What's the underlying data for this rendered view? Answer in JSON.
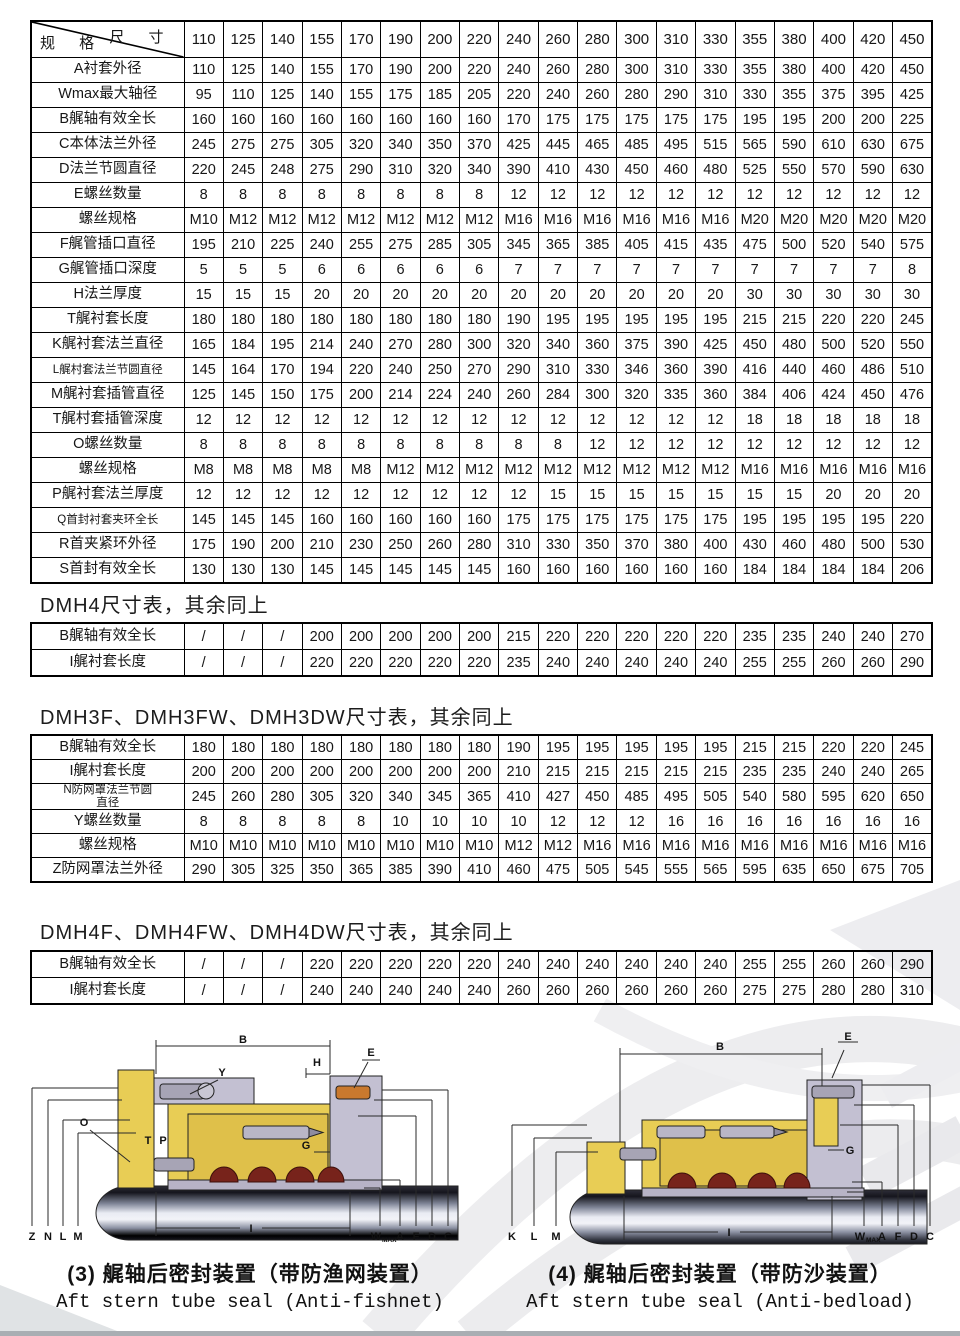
{
  "sizes_header": {
    "corner_top": "尺 寸",
    "corner_bottom": "规 格"
  },
  "tables": {
    "main": {
      "header": true,
      "columns": [
        "110",
        "125",
        "140",
        "155",
        "170",
        "190",
        "200",
        "220",
        "240",
        "260",
        "280",
        "300",
        "310",
        "330",
        "355",
        "380",
        "400",
        "420",
        "450"
      ],
      "rows": [
        {
          "label": "A衬套外径",
          "values": [
            110,
            125,
            140,
            155,
            170,
            190,
            200,
            220,
            240,
            260,
            280,
            300,
            310,
            330,
            355,
            380,
            400,
            420,
            450
          ]
        },
        {
          "label": "Wmax最大轴径",
          "values": [
            95,
            110,
            125,
            140,
            155,
            175,
            185,
            205,
            220,
            240,
            260,
            280,
            290,
            310,
            330,
            355,
            375,
            395,
            425
          ]
        },
        {
          "label": "B艉轴有效全长",
          "values": [
            160,
            160,
            160,
            160,
            160,
            160,
            160,
            160,
            170,
            175,
            175,
            175,
            175,
            175,
            195,
            195,
            200,
            200,
            225
          ]
        },
        {
          "label": "C本体法兰外径",
          "values": [
            245,
            275,
            275,
            305,
            320,
            340,
            350,
            370,
            425,
            445,
            465,
            485,
            495,
            515,
            565,
            590,
            610,
            630,
            675
          ]
        },
        {
          "label": "D法兰节圆直径",
          "values": [
            220,
            245,
            248,
            275,
            290,
            310,
            320,
            340,
            390,
            410,
            430,
            450,
            460,
            480,
            525,
            550,
            570,
            590,
            630
          ]
        },
        {
          "label": "E螺丝数量",
          "values": [
            8,
            8,
            8,
            8,
            8,
            8,
            8,
            8,
            12,
            12,
            12,
            12,
            12,
            12,
            12,
            12,
            12,
            12,
            12
          ]
        },
        {
          "label": "螺丝规格",
          "values": [
            "M10",
            "M12",
            "M12",
            "M12",
            "M12",
            "M12",
            "M12",
            "M12",
            "M16",
            "M16",
            "M16",
            "M16",
            "M16",
            "M16",
            "M20",
            "M20",
            "M20",
            "M20",
            "M20"
          ]
        },
        {
          "label": "F艉管插口直径",
          "values": [
            195,
            210,
            225,
            240,
            255,
            275,
            285,
            305,
            345,
            365,
            385,
            405,
            415,
            435,
            475,
            500,
            520,
            540,
            575
          ]
        },
        {
          "label": "G艉管插口深度",
          "values": [
            5,
            5,
            5,
            6,
            6,
            6,
            6,
            6,
            7,
            7,
            7,
            7,
            7,
            7,
            7,
            7,
            7,
            7,
            8
          ]
        },
        {
          "label": "H法兰厚度",
          "values": [
            15,
            15,
            15,
            20,
            20,
            20,
            20,
            20,
            20,
            20,
            20,
            20,
            20,
            20,
            30,
            30,
            30,
            30,
            30
          ]
        },
        {
          "label": "T艉衬套长度",
          "values": [
            180,
            180,
            180,
            180,
            180,
            180,
            180,
            180,
            190,
            195,
            195,
            195,
            195,
            195,
            215,
            215,
            220,
            220,
            245
          ]
        },
        {
          "label": "K艉衬套法兰直径",
          "values": [
            165,
            184,
            195,
            214,
            240,
            270,
            280,
            300,
            320,
            340,
            360,
            375,
            390,
            425,
            450,
            480,
            500,
            520,
            550
          ]
        },
        {
          "label": "L艉村套法兰节圆直径",
          "values": [
            145,
            164,
            170,
            194,
            220,
            240,
            250,
            270,
            290,
            310,
            330,
            346,
            360,
            390,
            416,
            440,
            460,
            486,
            510
          ]
        },
        {
          "label": "M艉衬套插管直径",
          "values": [
            125,
            145,
            150,
            175,
            200,
            214,
            224,
            240,
            260,
            284,
            300,
            320,
            335,
            360,
            384,
            406,
            424,
            450,
            476
          ]
        },
        {
          "label": "T艉村套插管深度",
          "values": [
            12,
            12,
            12,
            12,
            12,
            12,
            12,
            12,
            12,
            12,
            12,
            12,
            12,
            12,
            18,
            18,
            18,
            18,
            18
          ]
        },
        {
          "label": "O螺丝数量",
          "values": [
            8,
            8,
            8,
            8,
            8,
            8,
            8,
            8,
            8,
            8,
            12,
            12,
            12,
            12,
            12,
            12,
            12,
            12,
            12
          ]
        },
        {
          "label": "螺丝规格",
          "values": [
            "M8",
            "M8",
            "M8",
            "M8",
            "M8",
            "M12",
            "M12",
            "M12",
            "M12",
            "M12",
            "M12",
            "M12",
            "M12",
            "M12",
            "M16",
            "M16",
            "M16",
            "M16",
            "M16"
          ]
        },
        {
          "label": "P艉衬套法兰厚度",
          "values": [
            12,
            12,
            12,
            12,
            12,
            12,
            12,
            12,
            12,
            15,
            15,
            15,
            15,
            15,
            15,
            15,
            20,
            20,
            20
          ]
        },
        {
          "label": "Q首封衬套夹环全长",
          "values": [
            145,
            145,
            145,
            160,
            160,
            160,
            160,
            160,
            175,
            175,
            175,
            175,
            175,
            175,
            195,
            195,
            195,
            195,
            220
          ]
        },
        {
          "label": "R首夹紧环外径",
          "values": [
            175,
            190,
            200,
            210,
            230,
            250,
            260,
            280,
            310,
            330,
            350,
            370,
            380,
            400,
            430,
            460,
            480,
            500,
            530
          ]
        },
        {
          "label": "S首封有效全长",
          "values": [
            130,
            130,
            130,
            145,
            145,
            145,
            145,
            145,
            160,
            160,
            160,
            160,
            160,
            160,
            184,
            184,
            184,
            184,
            206
          ]
        }
      ]
    },
    "dmh4": {
      "header": false,
      "rows": [
        {
          "label": "B艉轴有效全长",
          "values": [
            "/",
            "/",
            "/",
            200,
            200,
            200,
            200,
            200,
            215,
            220,
            220,
            220,
            220,
            220,
            235,
            235,
            240,
            240,
            270
          ]
        },
        {
          "label": "I艉衬套长度",
          "values": [
            "/",
            "/",
            "/",
            220,
            220,
            220,
            220,
            220,
            235,
            240,
            240,
            240,
            240,
            240,
            255,
            255,
            260,
            260,
            290
          ]
        }
      ]
    },
    "dmh3f": {
      "header": false,
      "rows": [
        {
          "label": "B艉轴有效全长",
          "values": [
            180,
            180,
            180,
            180,
            180,
            180,
            180,
            180,
            190,
            195,
            195,
            195,
            195,
            195,
            215,
            215,
            220,
            220,
            245
          ]
        },
        {
          "label": "I艉村套长度",
          "values": [
            200,
            200,
            200,
            200,
            200,
            200,
            200,
            200,
            210,
            215,
            215,
            215,
            215,
            215,
            235,
            235,
            240,
            240,
            265
          ]
        },
        {
          "label": "N防网罩法兰节圆\n直径",
          "values": [
            245,
            260,
            280,
            305,
            320,
            340,
            345,
            365,
            410,
            427,
            450,
            485,
            495,
            505,
            540,
            580,
            595,
            620,
            650
          ]
        },
        {
          "label": "Y螺丝数量",
          "values": [
            8,
            8,
            8,
            8,
            8,
            10,
            10,
            10,
            10,
            12,
            12,
            12,
            16,
            16,
            16,
            16,
            16,
            16,
            16
          ]
        },
        {
          "label": "螺丝规格",
          "values": [
            "M10",
            "M10",
            "M10",
            "M10",
            "M10",
            "M10",
            "M10",
            "M10",
            "M12",
            "M12",
            "M16",
            "M16",
            "M16",
            "M16",
            "M16",
            "M16",
            "M16",
            "M16",
            "M16"
          ]
        },
        {
          "label": "Z防网罩法兰外径",
          "values": [
            290,
            305,
            325,
            350,
            365,
            385,
            390,
            410,
            460,
            475,
            505,
            545,
            555,
            565,
            595,
            635,
            650,
            675,
            705
          ]
        }
      ]
    },
    "dmh4f": {
      "header": false,
      "rows": [
        {
          "label": "B艉轴有效全长",
          "values": [
            "/",
            "/",
            "/",
            220,
            220,
            220,
            220,
            220,
            240,
            240,
            240,
            240,
            240,
            240,
            255,
            255,
            260,
            260,
            290
          ]
        },
        {
          "label": "I艉村套长度",
          "values": [
            "/",
            "/",
            "/",
            240,
            240,
            240,
            240,
            240,
            260,
            260,
            260,
            260,
            260,
            260,
            275,
            275,
            280,
            280,
            310
          ]
        }
      ]
    }
  },
  "headings": {
    "dmh4": "DMH4尺寸表，其余同上",
    "dmh3f": "DMH3F、DMH3FW、DMH3DW尺寸表，其余同上",
    "dmh4f": "DMH4F、DMH4FW、DMH4DW尺寸表，其余同上"
  },
  "captions": {
    "left_zh": "(3) 艉轴后密封装置（带防渔网装置）",
    "left_en": "Aft stern tube seal (Anti-fishnet)",
    "right_zh": "(4) 艉轴后密封装置（带防沙装置）",
    "right_en": "Aft stern tube seal (Anti-bedload)"
  },
  "diagram_left": {
    "labels": {
      "b": "B",
      "y": "Y",
      "h": "H",
      "e": "E",
      "o": "O",
      "t": "T",
      "p": "P",
      "g": "G",
      "z": "Z",
      "n": "N",
      "l": "L",
      "m": "M",
      "i": "I",
      "w": "W",
      "w_sub": "MAX",
      "a": "A",
      "f": "F",
      "d": "D",
      "c": "C"
    }
  },
  "diagram_right": {
    "labels": {
      "b": "B",
      "e": "E",
      "g": "G",
      "k": "K",
      "l": "L",
      "m": "M",
      "i": "I",
      "w": "W",
      "w_sub": "MAX",
      "a": "A",
      "f": "F",
      "d": "D",
      "c": "C"
    }
  },
  "colors": {
    "table_border": "#000000",
    "housing_yellow": "#e8cd55",
    "housing_gray": "#c3c0d2",
    "seal_red": "#77231b",
    "watermark_gray": "#ececee",
    "bottom_band": "#a9aeb3"
  }
}
